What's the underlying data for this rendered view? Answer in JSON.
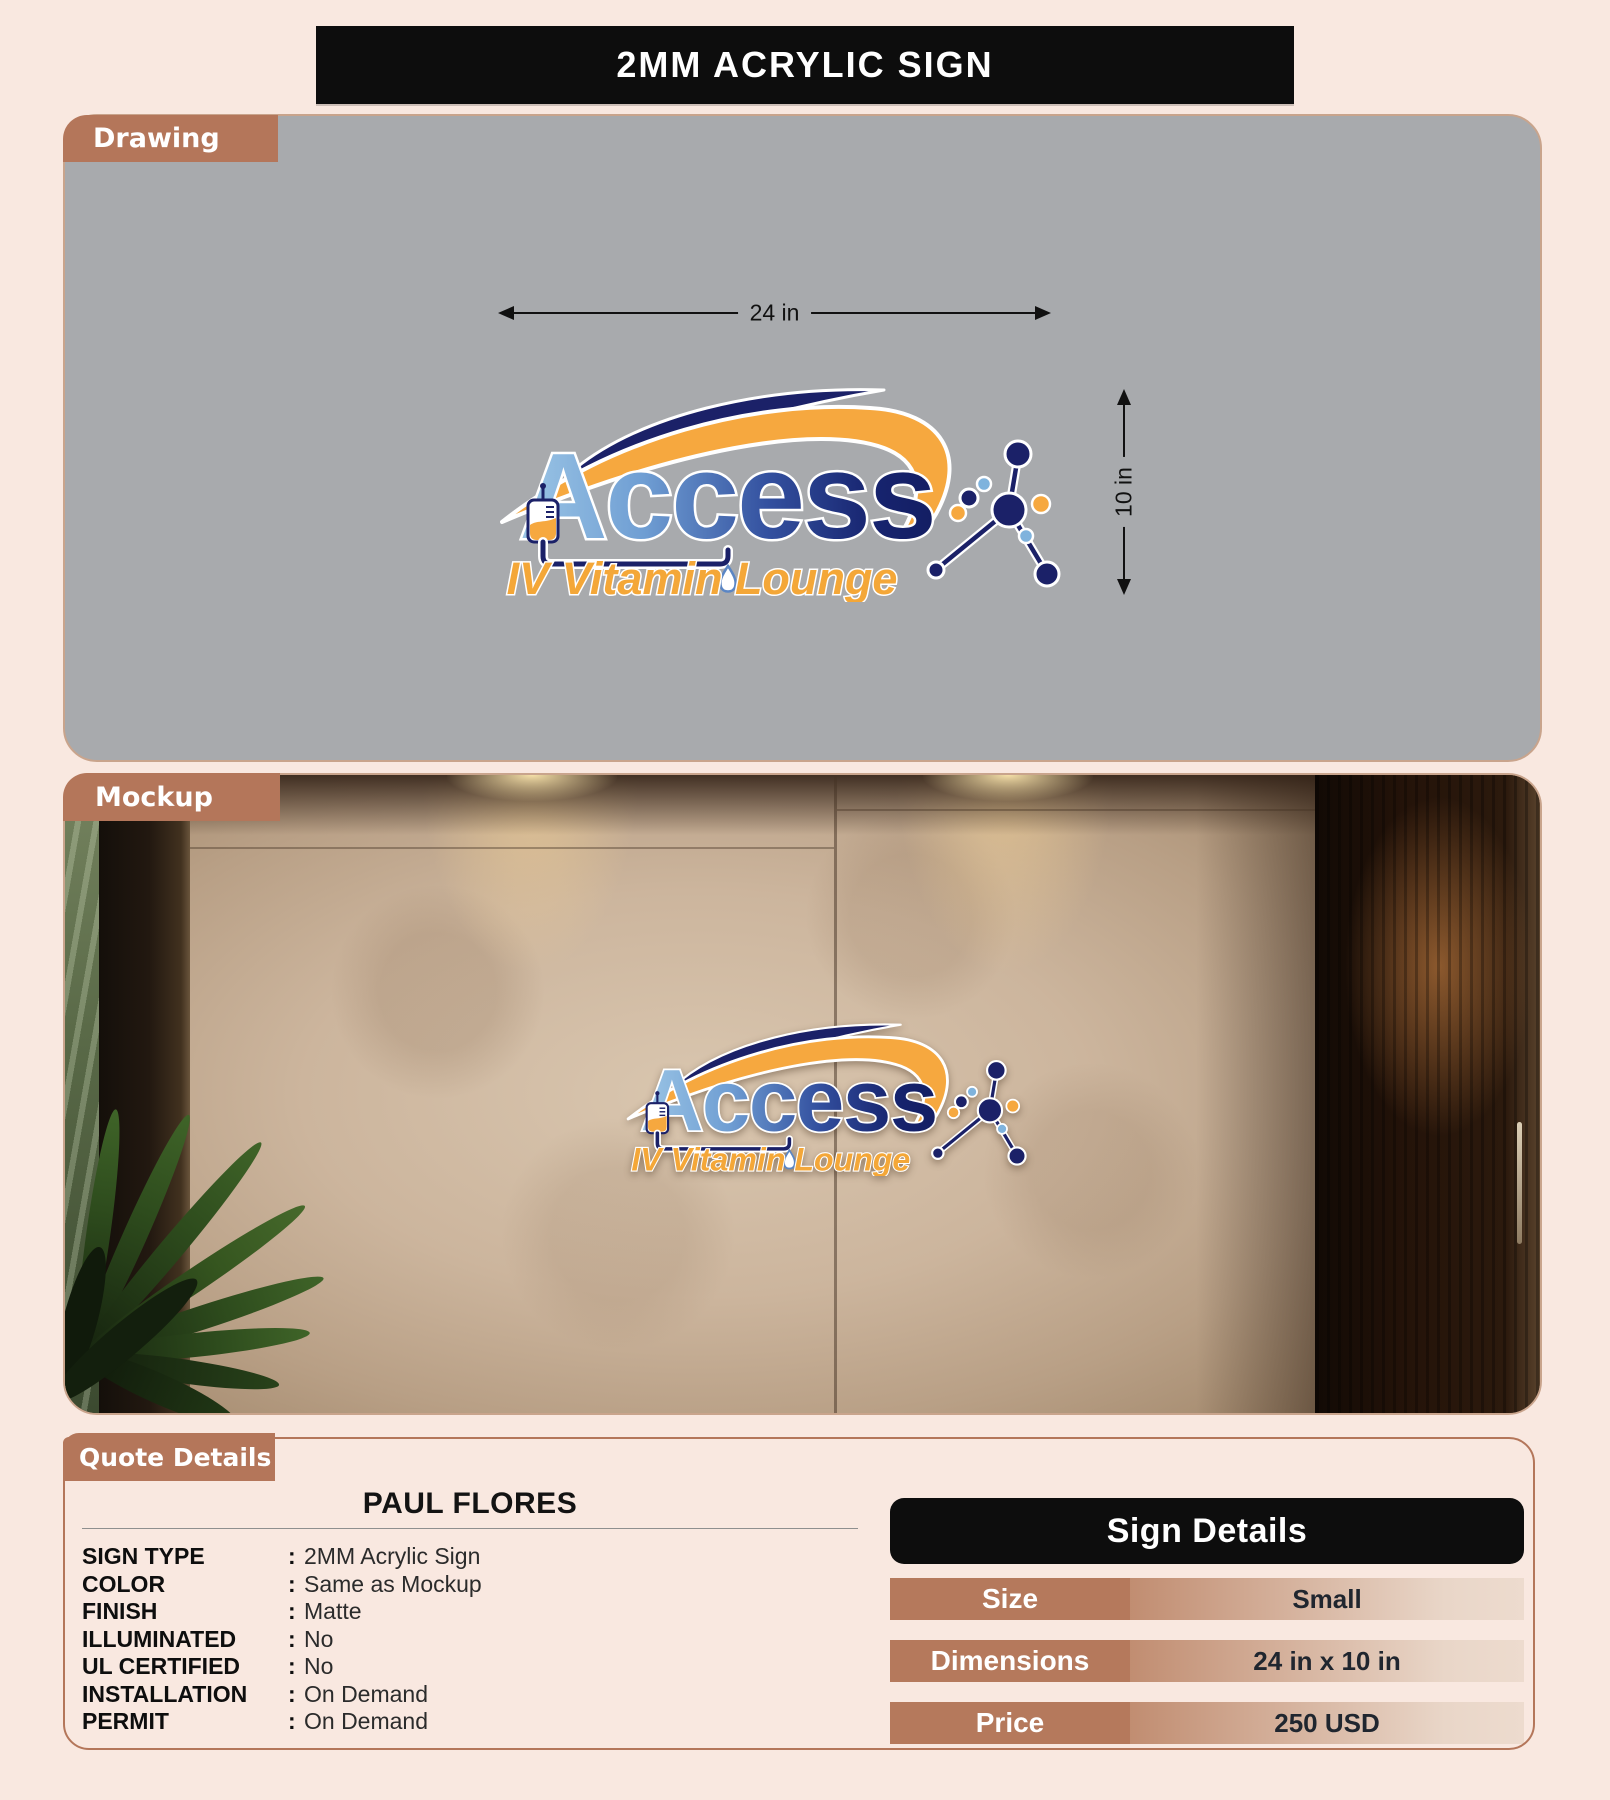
{
  "title": "2MM ACRYLIC SIGN",
  "sections": {
    "drawing_label": "Drawing",
    "mockup_label": "Mockup",
    "quote_label": "Quote Details"
  },
  "drawing": {
    "width_label": "24 in",
    "height_label": "10 in"
  },
  "logo": {
    "word": "Access",
    "tagline": "IV Vitamin Lounge"
  },
  "quote": {
    "customer": "PAUL FLORES",
    "separator": ":",
    "rows": [
      {
        "label": "SIGN TYPE",
        "value": "2MM Acrylic Sign"
      },
      {
        "label": "COLOR",
        "value": "Same as Mockup"
      },
      {
        "label": "FINISH",
        "value": "Matte"
      },
      {
        "label": "ILLUMINATED",
        "value": "No"
      },
      {
        "label": "UL CERTIFIED",
        "value": "No"
      },
      {
        "label": "INSTALLATION",
        "value": "On Demand"
      },
      {
        "label": "PERMIT",
        "value": "On Demand"
      }
    ]
  },
  "sign_details": {
    "header": "Sign Details",
    "rows": [
      {
        "label": "Size",
        "value": "Small"
      },
      {
        "label": "Dimensions",
        "value": "24 in x 10 in"
      },
      {
        "label": "Price",
        "value": "250 USD"
      }
    ]
  },
  "colors": {
    "accent_brown": "#b4765a",
    "banner_black": "#0d0d0d",
    "panel_gray": "#a8aaad",
    "logo_navy": "#1b2168",
    "logo_orange": "#f6a83f",
    "logo_light_blue": "#9cc6e6",
    "page_background": "#f9e8e0"
  }
}
